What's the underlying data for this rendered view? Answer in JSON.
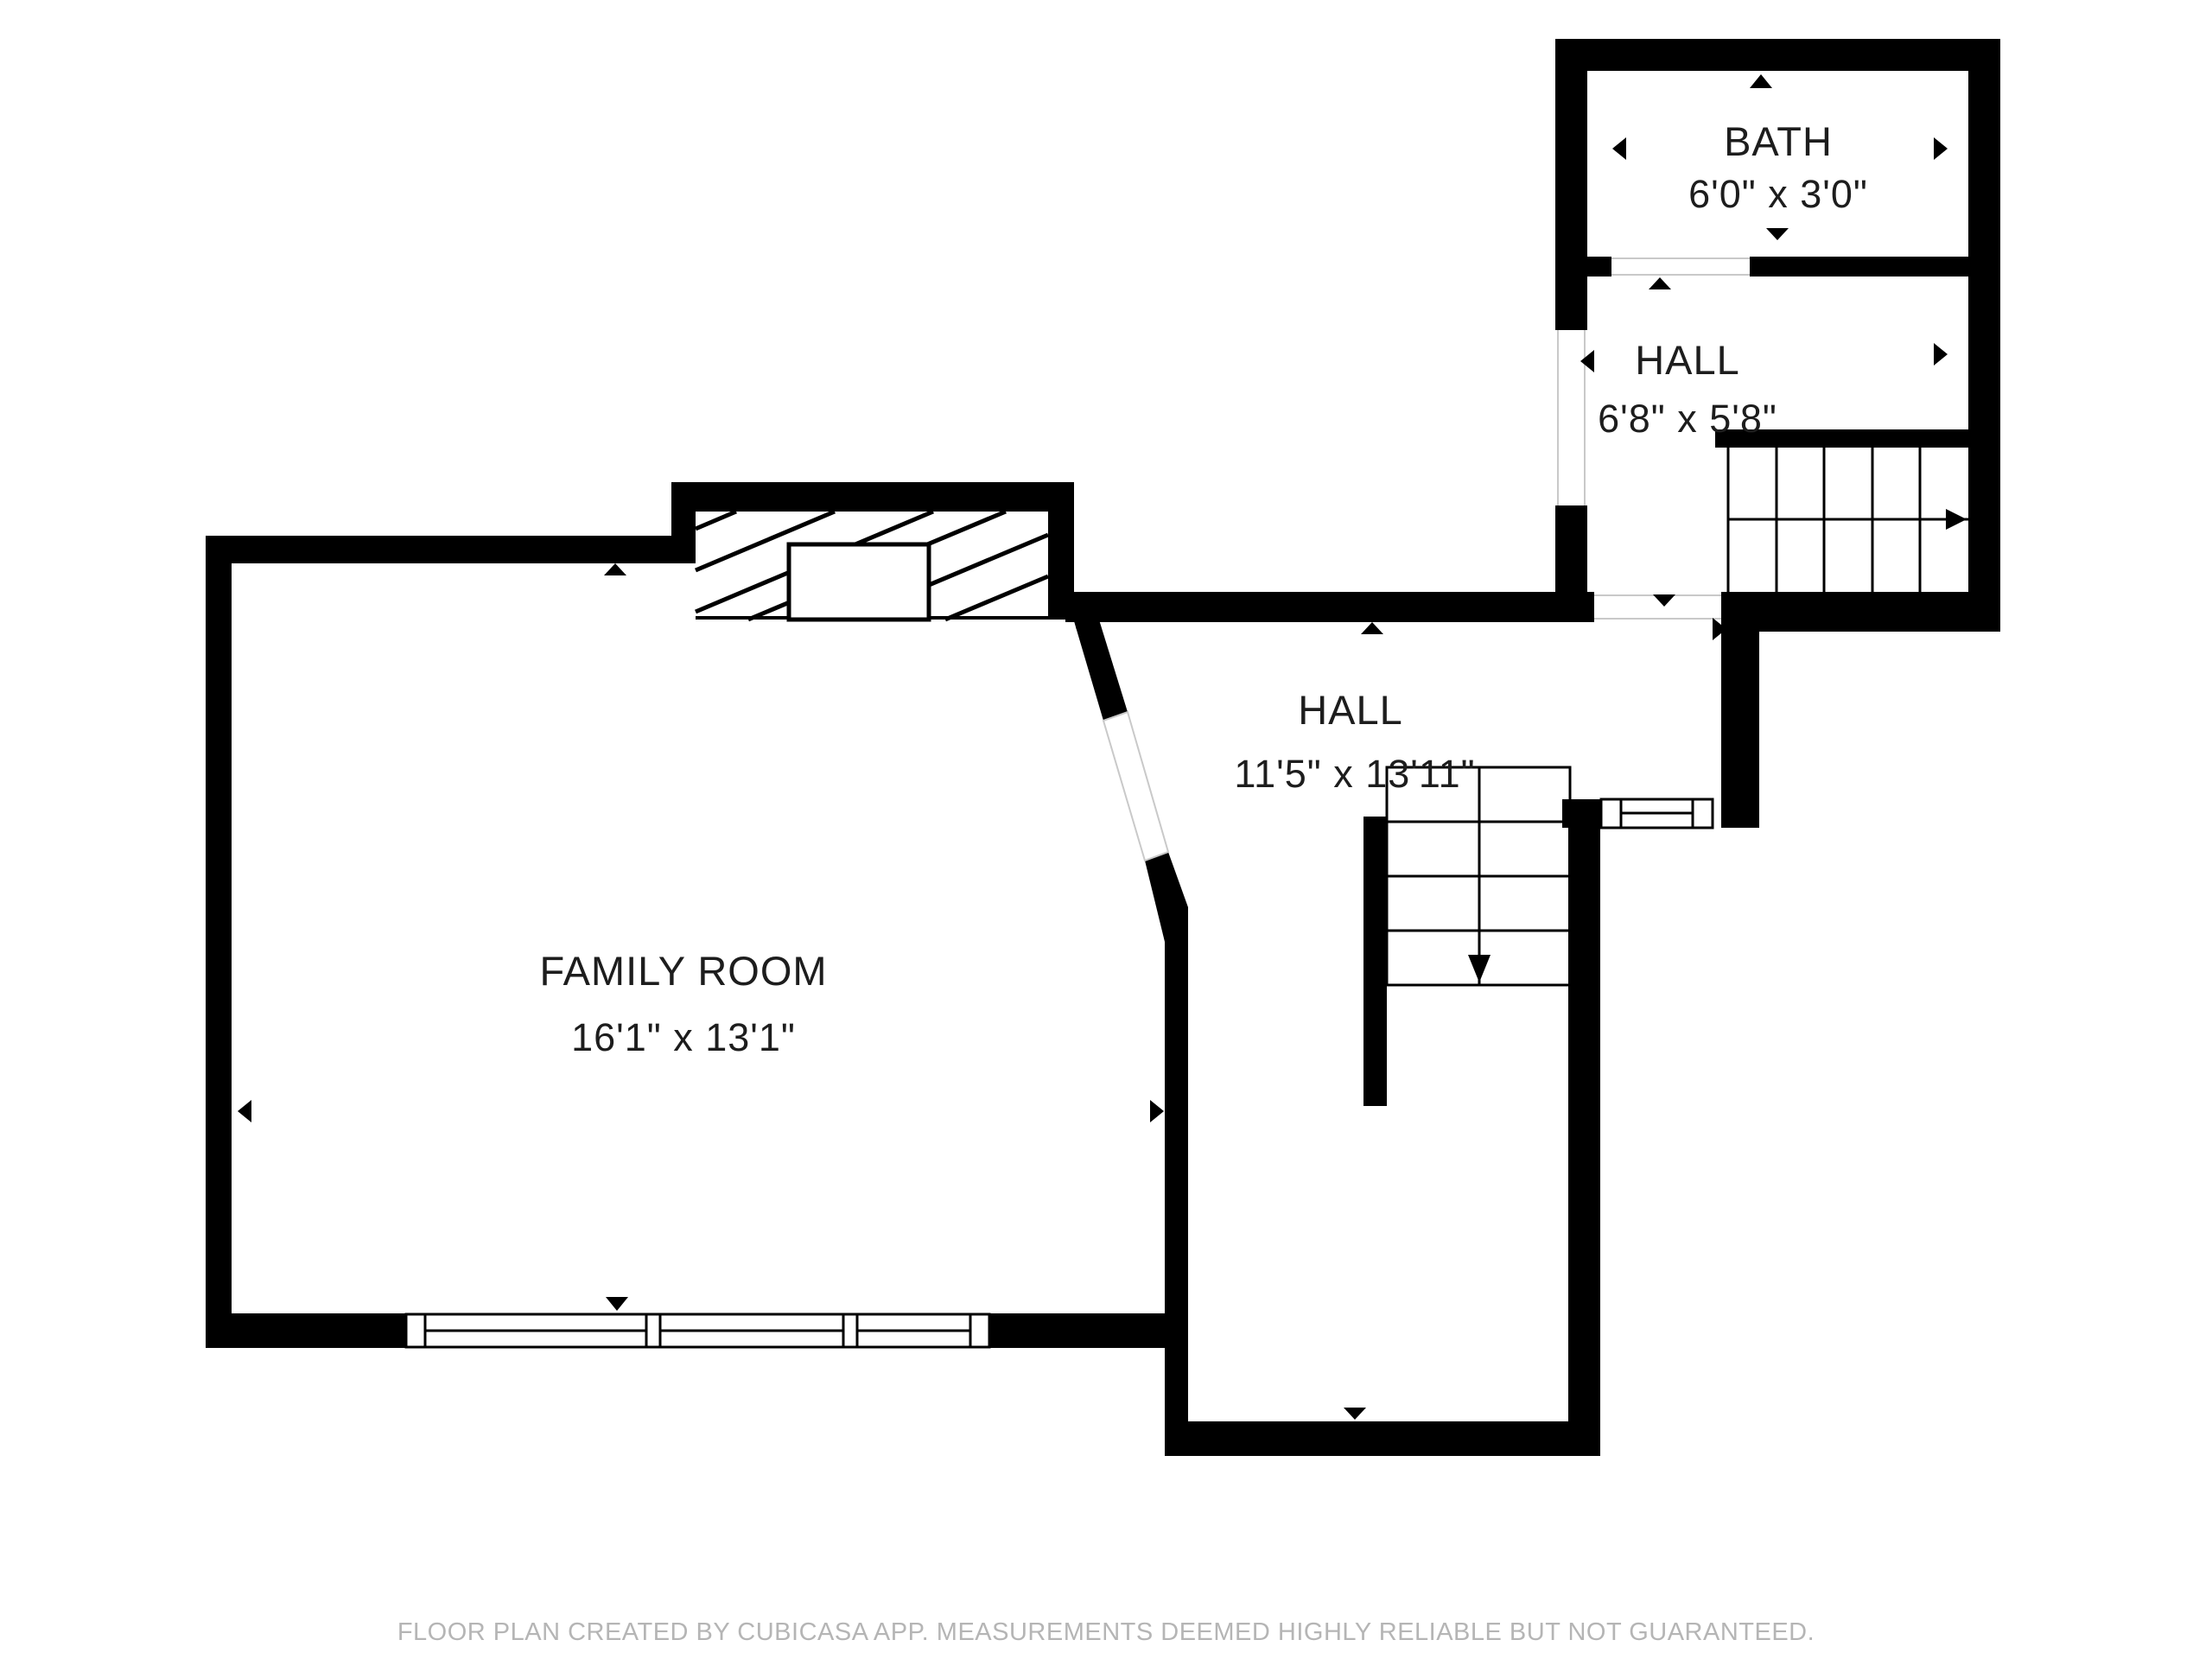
{
  "floor_plan": {
    "rooms": [
      {
        "name": "BATH",
        "dimensions": "6'0\" x 3'0\""
      },
      {
        "name": "HALL",
        "dimensions": "6'8\" x 5'8\""
      },
      {
        "name": "HALL",
        "dimensions": "11'5\" x 13'11\""
      },
      {
        "name": "FAMILY ROOM",
        "dimensions": "16'1\" x 13'1\""
      }
    ],
    "staircases": [
      {
        "id": "upper-staircase",
        "arrow_direction": "right"
      },
      {
        "id": "middle-staircase",
        "arrow_direction": "down"
      }
    ],
    "footer": "FLOOR PLAN CREATED BY CUBICASA APP. MEASUREMENTS DEEMED HIGHLY RELIABLE BUT NOT GUARANTEED.",
    "colors": {
      "wall": "#000000",
      "room_text": "#1d1d1d",
      "footer_text": "#b5b5b5",
      "door_threshold": "#c9c9c9",
      "background": "#ffffff"
    }
  }
}
